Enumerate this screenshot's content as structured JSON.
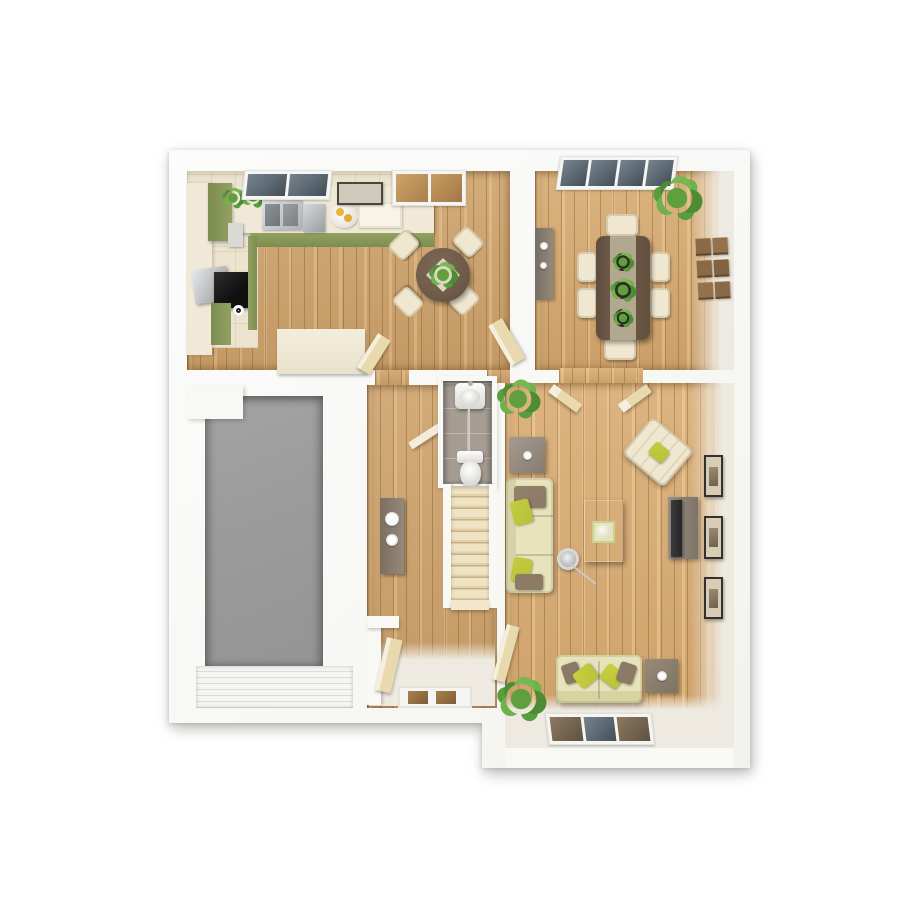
{
  "scene": {
    "kind": "3d-floor-plan-top-down-render",
    "floor_label_visible_text": "",
    "rooms": [
      {
        "name": "kitchen-breakfast",
        "floor_finish": "wood-and-cream-tile",
        "furniture": [
          "green-kitchen-units",
          "worktop",
          "sink",
          "steel-appliance",
          "hob",
          "oven",
          "counter-plants",
          "wall-art",
          "window",
          "french-door",
          "peninsula-unit",
          "round-table",
          "four-cream-chairs",
          "table-centre-plant",
          "two-open-doors"
        ]
      },
      {
        "name": "dining-room",
        "floor_finish": "wood",
        "furniture": [
          "rectangular-table",
          "stone-runner",
          "three-table-planters",
          "six-cream-chairs",
          "sideboard",
          "corner-plant",
          "wall-art-grid-6",
          "window"
        ]
      },
      {
        "name": "garage",
        "floor_finish": "grey-concrete",
        "furniture": [
          "ribbed-garage-door"
        ]
      },
      {
        "name": "hallway",
        "floor_finish": "wood",
        "furniture": [
          "console-table",
          "two-white-bowls",
          "storage-cupboard",
          "open-front-door-leaf",
          "front-door-with-glazing",
          "wc-door-leaf"
        ]
      },
      {
        "name": "wc",
        "floor_finish": "grey-tile",
        "furniture": [
          "basin",
          "toilet"
        ]
      },
      {
        "name": "staircase",
        "floor_finish": "beige-carpet",
        "furniture": [
          "ten-treads",
          "side-walls"
        ]
      },
      {
        "name": "living-room",
        "floor_finish": "wood",
        "furniture": [
          "three-seat-sofa",
          "two-seat-sofa",
          "tufted-armchair",
          "coffee-table-with-tray",
          "grey-side-table",
          "wood-side-table",
          "tv-unit",
          "tv",
          "floor-lamp",
          "three-wall-frames",
          "two-plants",
          "window",
          "double-doors-open",
          "hall-door-open"
        ]
      }
    ]
  },
  "colors": {
    "background": "#ffffff",
    "wall": "#f8f8f5",
    "wood_floor": "#cda26b",
    "kitchen_tile": "#ece4cf",
    "counter_cream": "#f0e9d8",
    "cabinet_green": "#93a162",
    "cabinet_green_dark": "#7c8d4f",
    "garage_floor": "#9c9c9c",
    "garage_door": "#f2f2f0",
    "wc_tile": "#a59c92",
    "stair_carpet": "#ecdebd",
    "sofa_cream": "#e7e3ba",
    "pillow_green": "#b7c236",
    "pillow_brown": "#8a7964",
    "table_dark_wood": "#6f5b49",
    "table_runner": "#b2a78f",
    "chair_cream": "#efe7cf",
    "gray_table": "#95897d",
    "tv_black": "#262626",
    "plant_green": "#5f9f3e",
    "door_cream": "#e9d9ae",
    "frame_dark": "#33312d",
    "frame_inner": "#d8cdb4",
    "glass_dark": "#5c6871",
    "window_frame": "#f5f5f3",
    "pale_floor": "#eeeae1",
    "silver": "#b9bcbf"
  }
}
